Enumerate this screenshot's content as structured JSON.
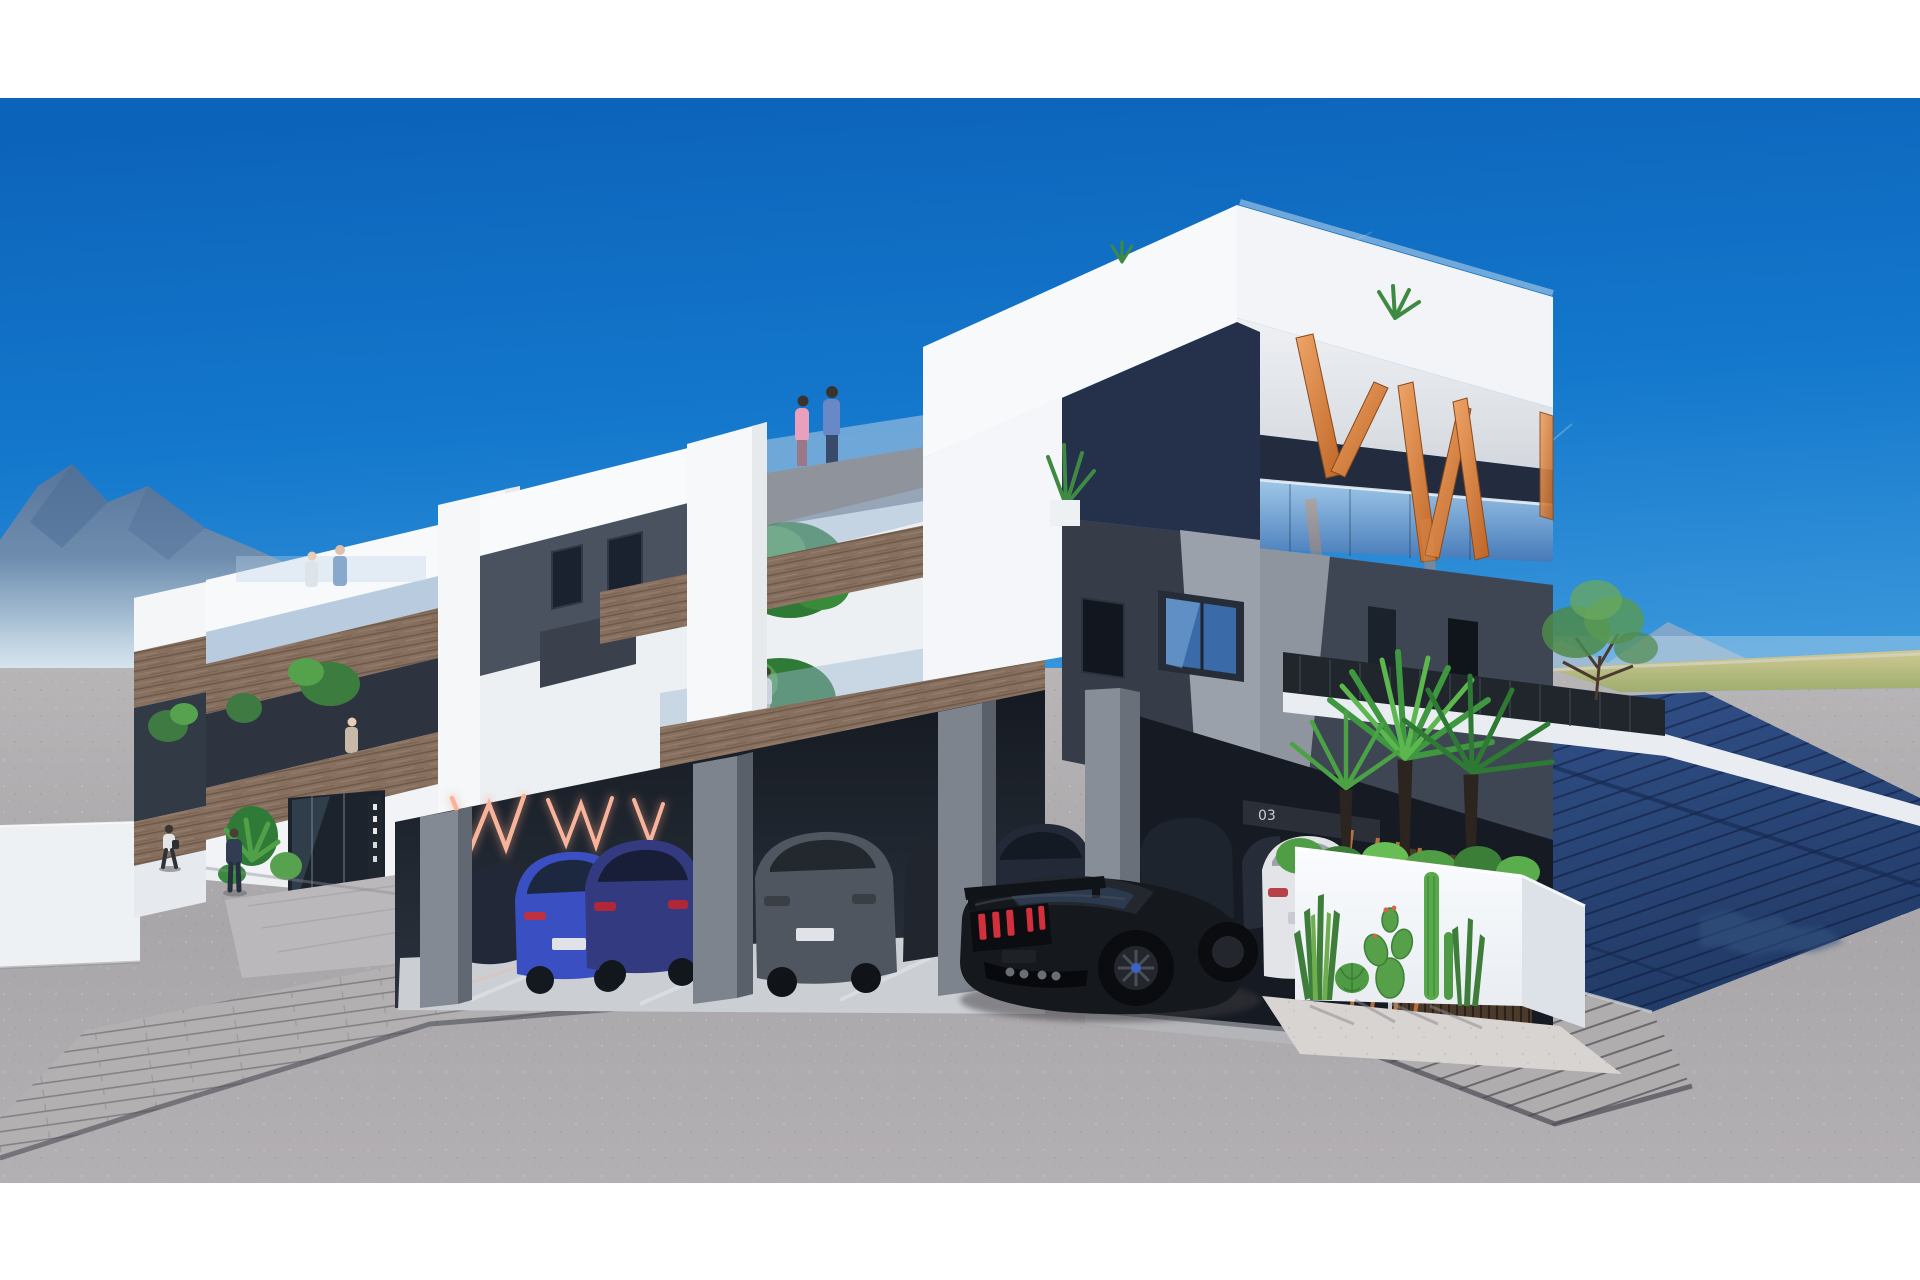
{
  "scene": {
    "title": "New-build apartment complex — exterior 3D visualization",
    "type": "architectural render, corner street view, sunny day",
    "letterbox": {
      "color": "#ffffff",
      "top_band_px": 98,
      "bottom_band_px": 97
    },
    "sky": {
      "top": "#0c64ba",
      "mid": "#2f90d8",
      "horizon": "#b5e2f4",
      "contrails": 2
    },
    "background": {
      "mountains_left": "hazy blue ridge",
      "mountains_right": "small distant peaks",
      "field_strip_right": "#b3bd7c",
      "road": "light gray asphalt with speckle"
    }
  },
  "building": {
    "storeys": 3,
    "style": "white angular concrete frames, charcoal cube volume, timber balcony fascias, glass balustrades",
    "penthouse_decor_letters": {
      "text": "VW",
      "color": "#d98a4e",
      "location": "top roof terrace, copper slats"
    },
    "carport": {
      "neon_letters": "WWW",
      "neon_color": "#f2a58c",
      "pillars": "gray concrete",
      "floor": "polished concrete"
    },
    "garage": {
      "unit_number": "03",
      "door_material": "dark timber slats",
      "trellis_color": "#c87840"
    },
    "entrance": {
      "glazing": "dark glass lobby",
      "sign": "vertical dark sign with small white glyphs"
    }
  },
  "labels": {
    "garage_unit_number": "03"
  },
  "vehicles": [
    {
      "type": "muscle coupe with rear wing",
      "color": "black",
      "detail": "red triple taillights",
      "position": "driveway foreground"
    },
    {
      "type": "hatchback",
      "color": "blue",
      "position": "carport"
    },
    {
      "type": "suv",
      "color": "dark purple-blue",
      "position": "carport"
    },
    {
      "type": "suv",
      "color": "gray",
      "position": "carport"
    },
    {
      "type": "sedan",
      "color": "dark navy",
      "position": "carport"
    },
    {
      "type": "suv",
      "color": "dark gray",
      "position": "carport right wing"
    },
    {
      "type": "suv",
      "color": "white",
      "position": "carport right wing"
    }
  ],
  "people": [
    {
      "where": "mid roof terrace",
      "who": "woman in pink and man in blue"
    },
    {
      "where": "left roof terrace",
      "who": "two small figures"
    },
    {
      "where": "first-floor balcony",
      "who": "woman in white"
    },
    {
      "where": "left balconies",
      "who": "two residents"
    },
    {
      "where": "sidewalk",
      "who": "two pedestrians"
    }
  ],
  "vegetation": [
    "fan palms with dark fibrous trunks",
    "green shrubs in planter",
    "sansevieria, barrel cactus, prickly pear, columnar cacti on gravel bed",
    "airy tree behind slatted fence",
    "balcony trees and rooftop sprigs"
  ],
  "ground": {
    "paver_apron": "gray cobble band in front of carport",
    "ramp": "paver ramp at right, partly in deep blue shadow",
    "shadow_color": "#24437a"
  },
  "palette": {
    "white_wall": "#f6f8fa",
    "soffit": "#dfe3e8",
    "charcoal": "#3e4553",
    "charcoal_light": "#9aa1ab",
    "wood": "#87705f",
    "glass": "#6f9fd0",
    "copper": "#d98a4e",
    "asphalt": "#b2afb2",
    "mountain": "#5d7a9e"
  }
}
